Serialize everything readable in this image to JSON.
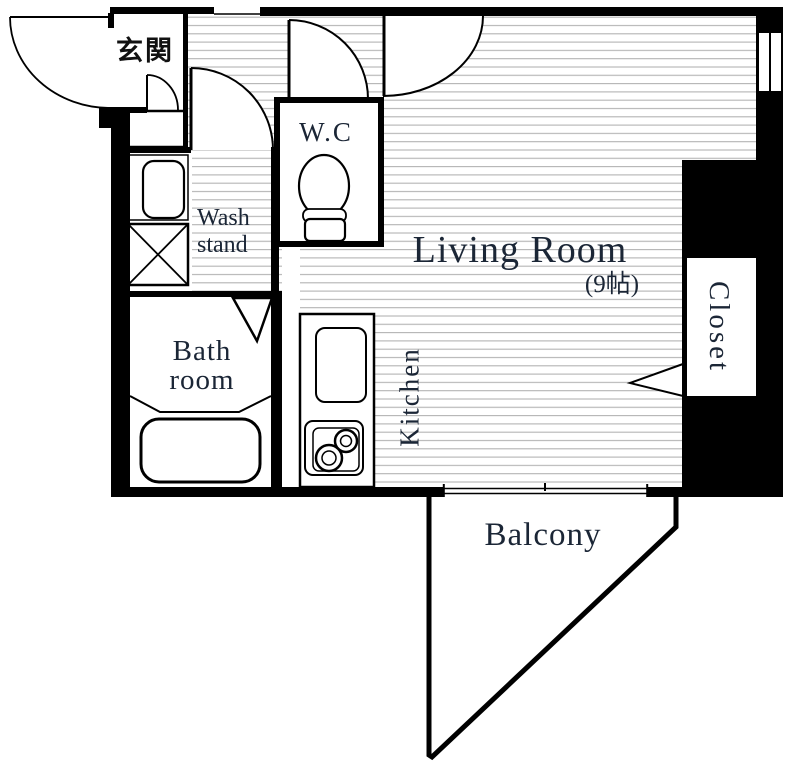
{
  "title": "Apartment floor plan",
  "colors": {
    "wall": "#000000",
    "floor_hatch_line": "#b3b3b3",
    "label_text": "#1b2636",
    "entrance_text": "#111111",
    "background": "#ffffff"
  },
  "rooms": {
    "entrance": {
      "label": "玄関"
    },
    "wc": {
      "label": "W.C"
    },
    "wash_stand": {
      "line1": "Wash",
      "line2": "stand"
    },
    "bathroom": {
      "line1": "Bath",
      "line2": "room"
    },
    "living": {
      "label": "Living Room",
      "size": "(9帖)"
    },
    "kitchen": {
      "label": "Kitchen"
    },
    "closet": {
      "label": "Closet"
    },
    "balcony": {
      "label": "Balcony"
    }
  }
}
